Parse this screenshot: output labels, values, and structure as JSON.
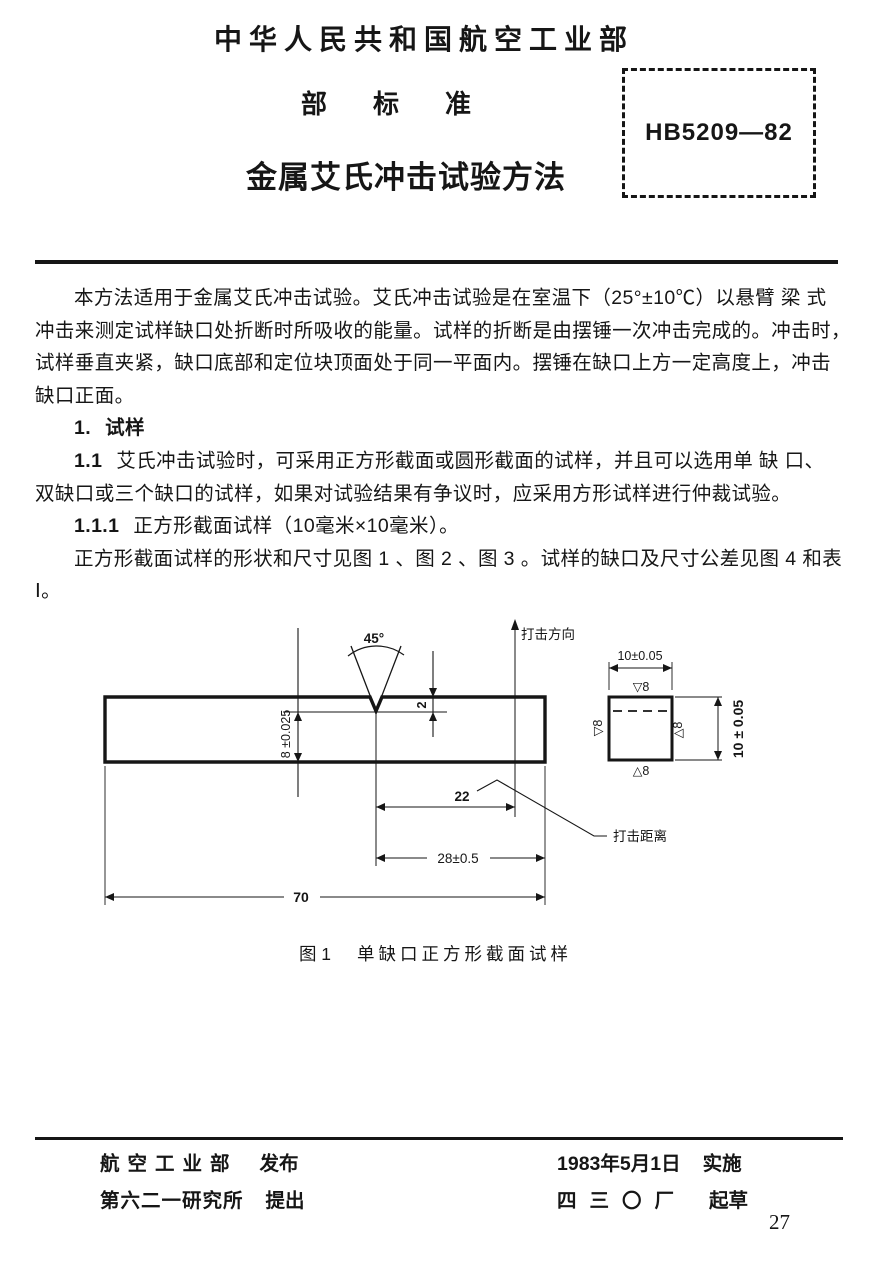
{
  "header": {
    "ministry": "中华人民共和国航空工业部",
    "standard_type": "部标准",
    "title": "金属艾氏冲击试验方法",
    "standard_number": "HB5209—82"
  },
  "body": {
    "lines": [
      "本方法适用于金属艾氏冲击试验。艾氏冲击试验是在室温下（25°±10℃）以悬臂 梁 式",
      "冲击来测定试样缺口处折断时所吸收的能量。试样的折断是由摆锤一次冲击完成的。冲击时，",
      "试样垂直夹紧，缺口底部和定位块顶面处于同一平面内。摆锤在缺口上方一定高度上，冲击",
      "缺口正面。"
    ],
    "section1": {
      "num": "1.",
      "title": "试样"
    },
    "clause11": {
      "num": "1.1",
      "line1": "艾氏冲击试验时，可采用正方形截面或圆形截面的试样，并且可以选用单 缺 口、",
      "line2": "双缺口或三个缺口的试样，如果对试验结果有争议时，应采用方形试样进行仲裁试验。"
    },
    "clause111": {
      "num": "1.1.1",
      "text": "正方形截面试样（10毫米×10毫米）。"
    },
    "para2": {
      "line1": "正方形截面试样的形状和尺寸见图 1 、图 2 、图 3 。试样的缺口及尺寸公差见图 4 和表",
      "line2": "Ⅰ。"
    }
  },
  "figure": {
    "caption_label": "图 1",
    "caption_text": "单缺口正方形截面试样",
    "angle_label": "45°",
    "notch_depth_label": "2",
    "ligament_label": "8 ±0.025",
    "impact_direction_label": "打击方向",
    "impact_distance_label": "打击距离",
    "impact_distance_value": "22",
    "notch_to_end_label": "28±0.5",
    "total_length_label": "70",
    "section_width_label": "10±0.05",
    "section_height_label": "10 ± 0.05",
    "roughness_top": "▽8",
    "roughness_left": "▽8",
    "roughness_right": "△8",
    "roughness_bottom": "△8"
  },
  "footer": {
    "issued_by": "航空工业部",
    "issued_action": "发布",
    "proposed_by": "第六二一研究所",
    "proposed_action": "提出",
    "implementation_date": "1983年5月1日",
    "implementation_action": "实施",
    "drafted_by": "四三〇厂",
    "drafted_action": "起草",
    "page_number": "27"
  }
}
